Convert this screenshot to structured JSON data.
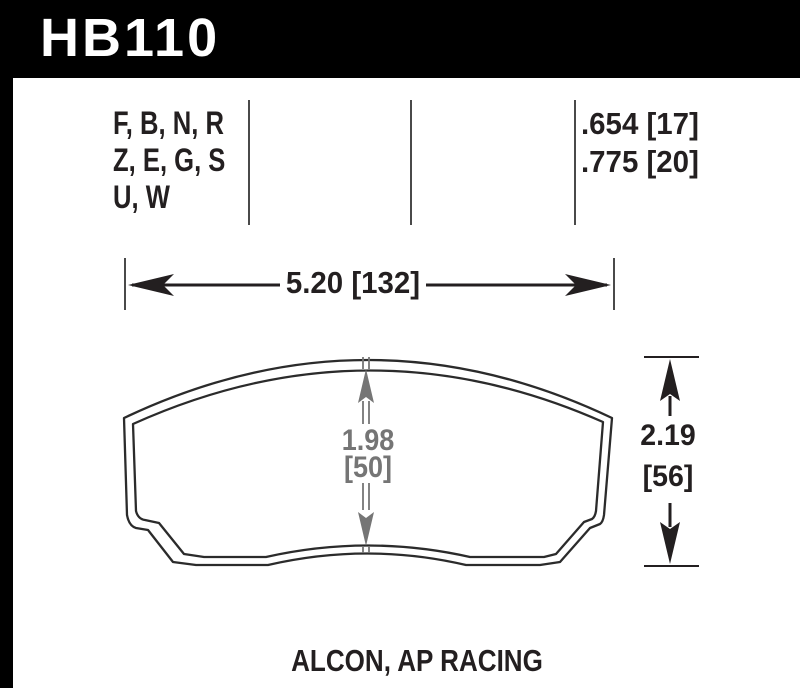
{
  "title_block": {
    "part_number": "HB110"
  },
  "spec_row": {
    "compounds": [
      "F, B, N, R",
      "Z, E, G, S",
      "U, W"
    ],
    "pad_thickness": [
      ".654 [17]",
      ".775 [20]"
    ]
  },
  "dimensions": {
    "width": "5.20 [132]",
    "height": {
      "value": "2.19",
      "mm": "[56]"
    },
    "center": {
      "value": "1.98",
      "mm": "[50]"
    }
  },
  "footer": {
    "applications": "ALCON, AP RACING"
  },
  "colors": {
    "header_bg": "#000000",
    "header_text": "#ffffff",
    "text": "#231f20",
    "dimension_gray": "#757575",
    "outline": "#2b2b2b",
    "divider": "#4a4a4a"
  }
}
